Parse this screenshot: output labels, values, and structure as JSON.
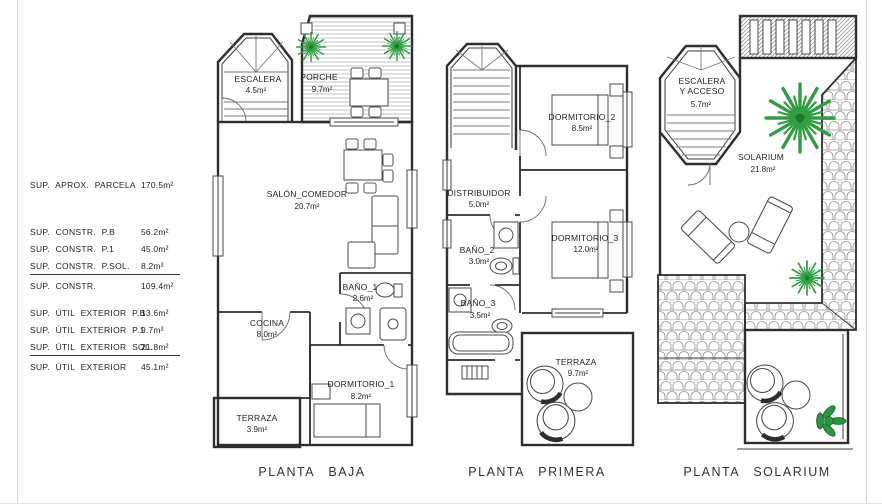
{
  "summary": {
    "rows": [
      {
        "label": "SUP. APROX. PARCELA",
        "value": "170.5m²"
      },
      {
        "label": "SUP. CONSTR. P.B",
        "value": "56.2m²"
      },
      {
        "label": "SUP. CONSTR. P.1",
        "value": "45.0m²"
      },
      {
        "label": "SUP. CONSTR. P.SOL.",
        "value": "8.2m²"
      },
      {
        "label": "SUP. CONSTR.",
        "value": "109.4m²"
      },
      {
        "label": "SUP. ÚTIL EXTERIOR P.B",
        "value": "13.6m²"
      },
      {
        "label": "SUP. ÚTIL EXTERIOR P.1",
        "value": "9.7m²"
      },
      {
        "label": "SUP. ÚTIL EXTERIOR SOL.",
        "value": "21.8m²"
      },
      {
        "label": "SUP. ÚTIL EXTERIOR",
        "value": "45.1m²"
      }
    ]
  },
  "plans": {
    "baja": {
      "caption": "PLANTA BAJA",
      "rooms": {
        "escalera": {
          "name": "ESCALERA",
          "area": "4.5m²"
        },
        "porche": {
          "name": "PORCHE",
          "area": "9.7m²"
        },
        "salon": {
          "name": "SALÓN_COMEDOR",
          "area": "20.7m²"
        },
        "bano1": {
          "name": "BAÑO_1",
          "area": "2.6m²"
        },
        "cocina": {
          "name": "COCINA",
          "area": "8.0m²"
        },
        "dormitorio1": {
          "name": "DORMITORIO_1",
          "area": "8.2m²"
        },
        "terraza": {
          "name": "TERRAZA",
          "area": "3.9m²"
        }
      }
    },
    "primera": {
      "caption": "PLANTA PRIMERA",
      "rooms": {
        "dormitorio2": {
          "name": "DORMITORIO_2",
          "area": "8.5m²"
        },
        "distribuidor": {
          "name": "DISTRIBUIDOR",
          "area": "5.0m²"
        },
        "bano2": {
          "name": "BAÑO_2",
          "area": "3.0m²"
        },
        "dormitorio3": {
          "name": "DORMITORIO_3",
          "area": "12.0m²"
        },
        "bano3": {
          "name": "BAÑO_3",
          "area": "3.5m²"
        },
        "terraza": {
          "name": "TERRAZA",
          "area": "9.7m²"
        }
      }
    },
    "solarium": {
      "caption": "PLANTA SOLARIUM",
      "rooms": {
        "escalera": {
          "name_line1": "ESCALERA",
          "name_line2": "Y ACCESO",
          "area": "5.7m²"
        },
        "solarium": {
          "name": "SOLARIUM",
          "area": "21.8m²"
        }
      }
    }
  },
  "colors": {
    "wall_line": "#2e2e2e",
    "hatch": "#b4b4b4",
    "tile": "#909090",
    "palm_green": "#2f9e41",
    "bush_green": "#2d9440"
  }
}
